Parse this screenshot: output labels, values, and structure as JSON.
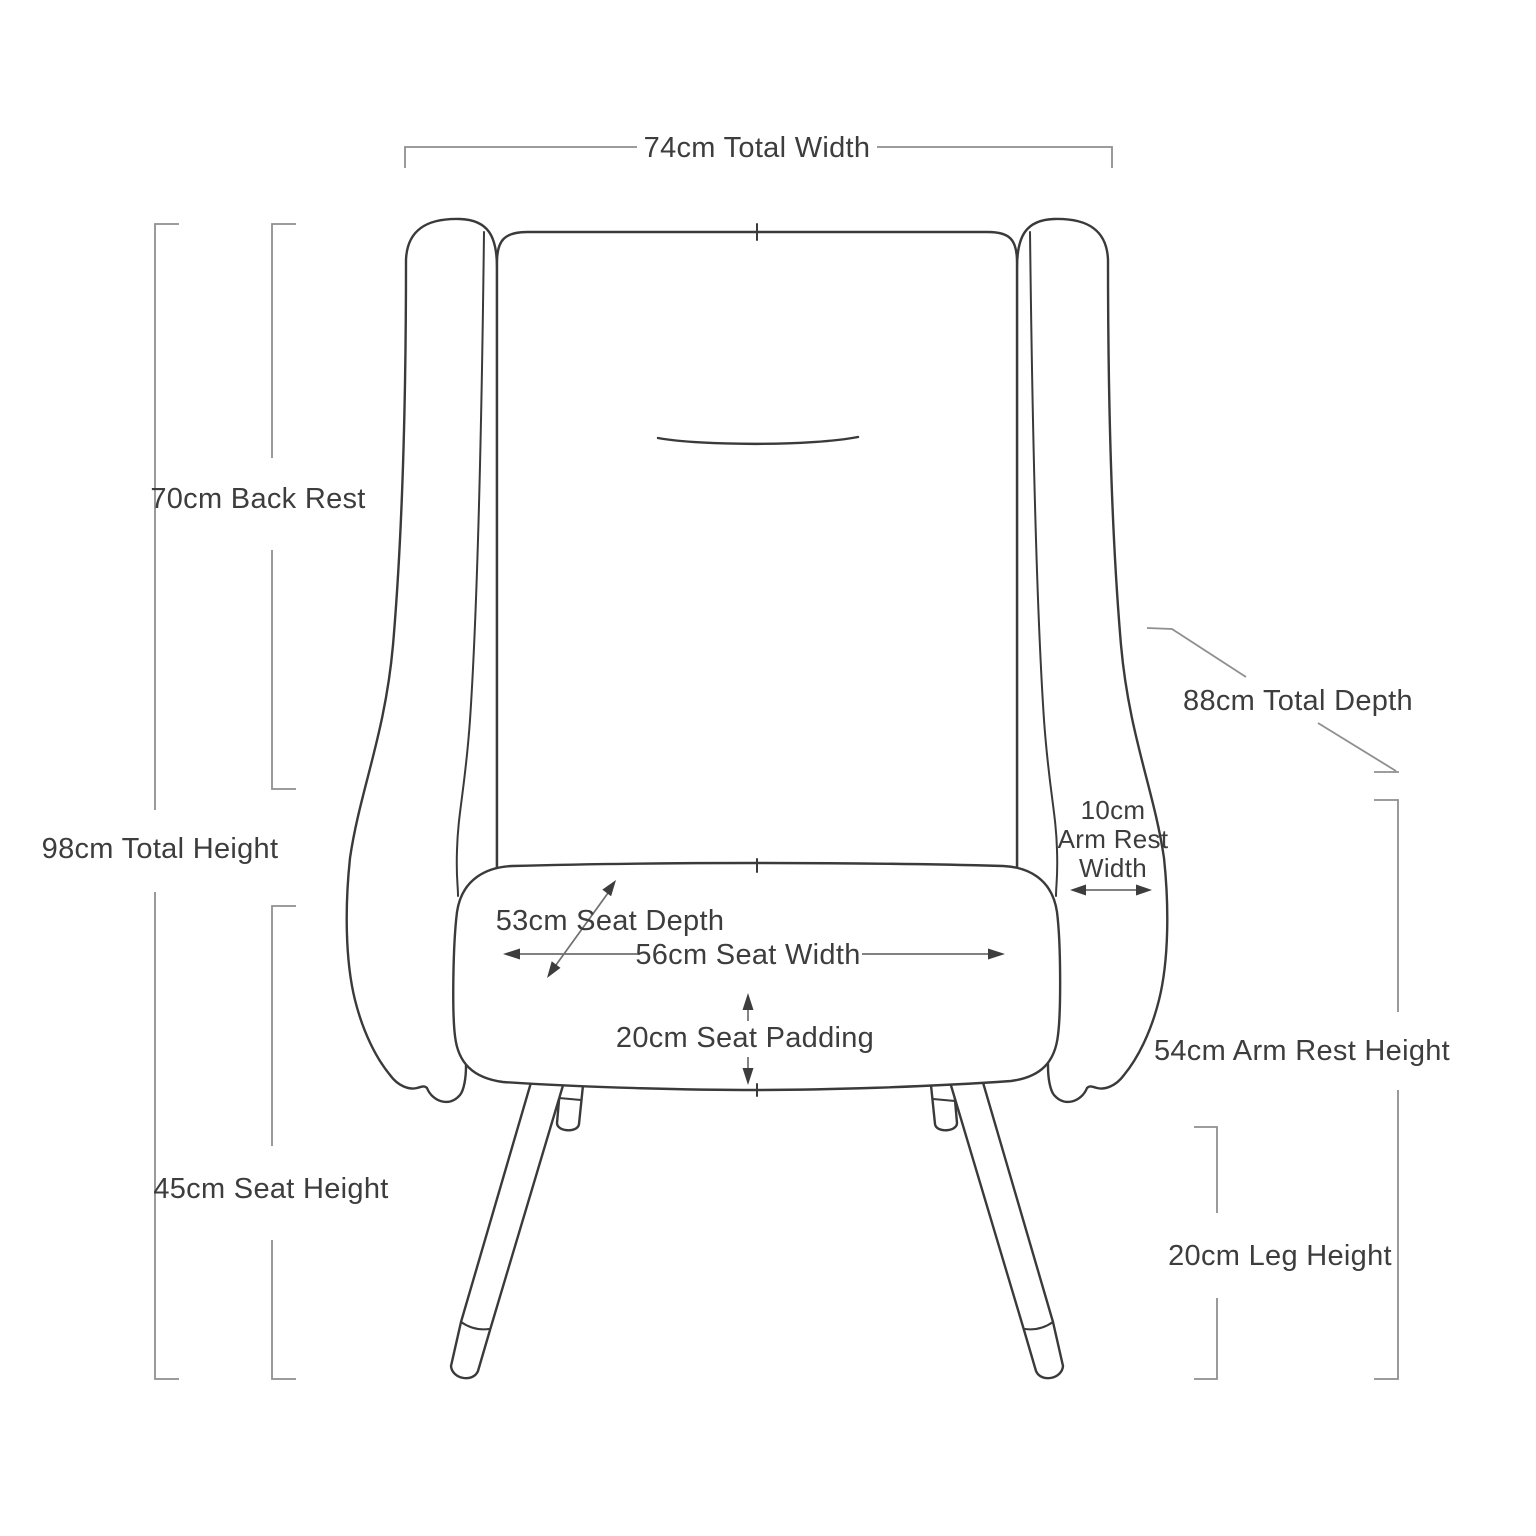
{
  "diagram": {
    "subject": "armchair-front-view-dimension-diagram",
    "colors": {
      "background": "#ffffff",
      "chair_outline": "#3a3a3a",
      "dimension_line": "#8f8f8f",
      "text": "#3d3d3d"
    },
    "dims": {
      "total_width": {
        "text": "74cm Total Width",
        "value_cm": 74
      },
      "back_rest": {
        "text": "70cm Back Rest",
        "value_cm": 70
      },
      "total_height": {
        "text": "98cm Total Height",
        "value_cm": 98
      },
      "seat_height": {
        "text": "45cm Seat Height",
        "value_cm": 45
      },
      "total_depth": {
        "text": "88cm Total Depth",
        "value_cm": 88
      },
      "arm_rest_width": {
        "line1": "10cm",
        "line2": "Arm Rest",
        "line3": "Width",
        "value_cm": 10
      },
      "arm_rest_height": {
        "text": "54cm Arm Rest Height",
        "value_cm": 54
      },
      "leg_height": {
        "text": "20cm Leg Height",
        "value_cm": 20
      },
      "seat_depth": {
        "text": "53cm Seat Depth",
        "value_cm": 53
      },
      "seat_width": {
        "text": "56cm Seat Width",
        "value_cm": 56
      },
      "seat_padding": {
        "text": "20cm Seat Padding",
        "value_cm": 20
      }
    }
  }
}
